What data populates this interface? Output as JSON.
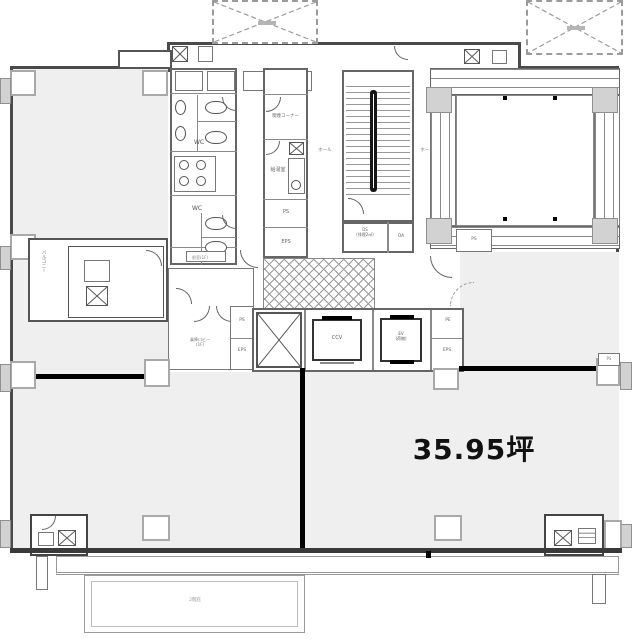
{
  "plan": {
    "area_label": "35.95坪",
    "rooms": {
      "wc_upper": "WC",
      "wc_lower": "WC",
      "smoking_corner": "喫煙コーナー",
      "kitchenette": "給湯室",
      "hall_left": "ホール",
      "hall_right": "ホール",
      "stair_ds_line1": "DS",
      "stair_ds_line2": "(排煙2㎡)",
      "stair_oa": "OA",
      "elevator_main": "CCV",
      "elevator_service_line1": "EV",
      "elevator_service_line2": "(荷物)",
      "lobby_line1": "乗降ロビー",
      "lobby_line2": "(1F)",
      "corridor_note": "前室(1F)",
      "balcony_side": "バルコニー",
      "canopy": "2階庇"
    },
    "shafts": {
      "ps_service": "PS",
      "eps_service": "EPS",
      "ps_lobby": "PS",
      "eps_lobby": "EPS",
      "pe": "PE",
      "eps_elevator": "EPS",
      "ps_void": "PS",
      "ps_wall": "PS"
    }
  }
}
